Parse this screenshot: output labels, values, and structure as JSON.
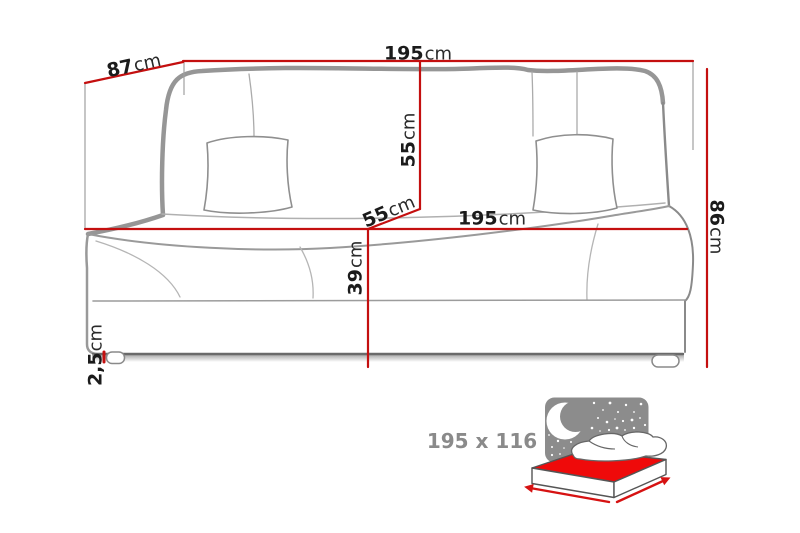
{
  "diagram": {
    "subject": "sofa-bed dimension drawing",
    "dimensions": {
      "top_width": {
        "value": "195",
        "unit": "cm"
      },
      "depth": {
        "value": "87",
        "unit": "cm"
      },
      "back_height": {
        "value": "55",
        "unit": "cm"
      },
      "seat_depth": {
        "value": "55",
        "unit": "cm"
      },
      "seat_width": {
        "value": "195",
        "unit": "cm"
      },
      "seat_height": {
        "value": "39",
        "unit": "cm"
      },
      "total_height": {
        "value": "86",
        "unit": "cm"
      },
      "leg_height": {
        "value": "2,5",
        "unit": "cm"
      }
    },
    "bed_icon": {
      "sleeping_area": "195 x 116"
    },
    "colors": {
      "dimension_line": "#c40f0f",
      "extension_line": "#9f9f9f",
      "mattress_red": "#ef0a0a",
      "arrow_red": "#d61212",
      "night_sky": "#8c8c8c",
      "sketch_gray": "#969696",
      "label_text": "#1b1b1b",
      "bed_label_gray": "#8a8a8a"
    }
  }
}
